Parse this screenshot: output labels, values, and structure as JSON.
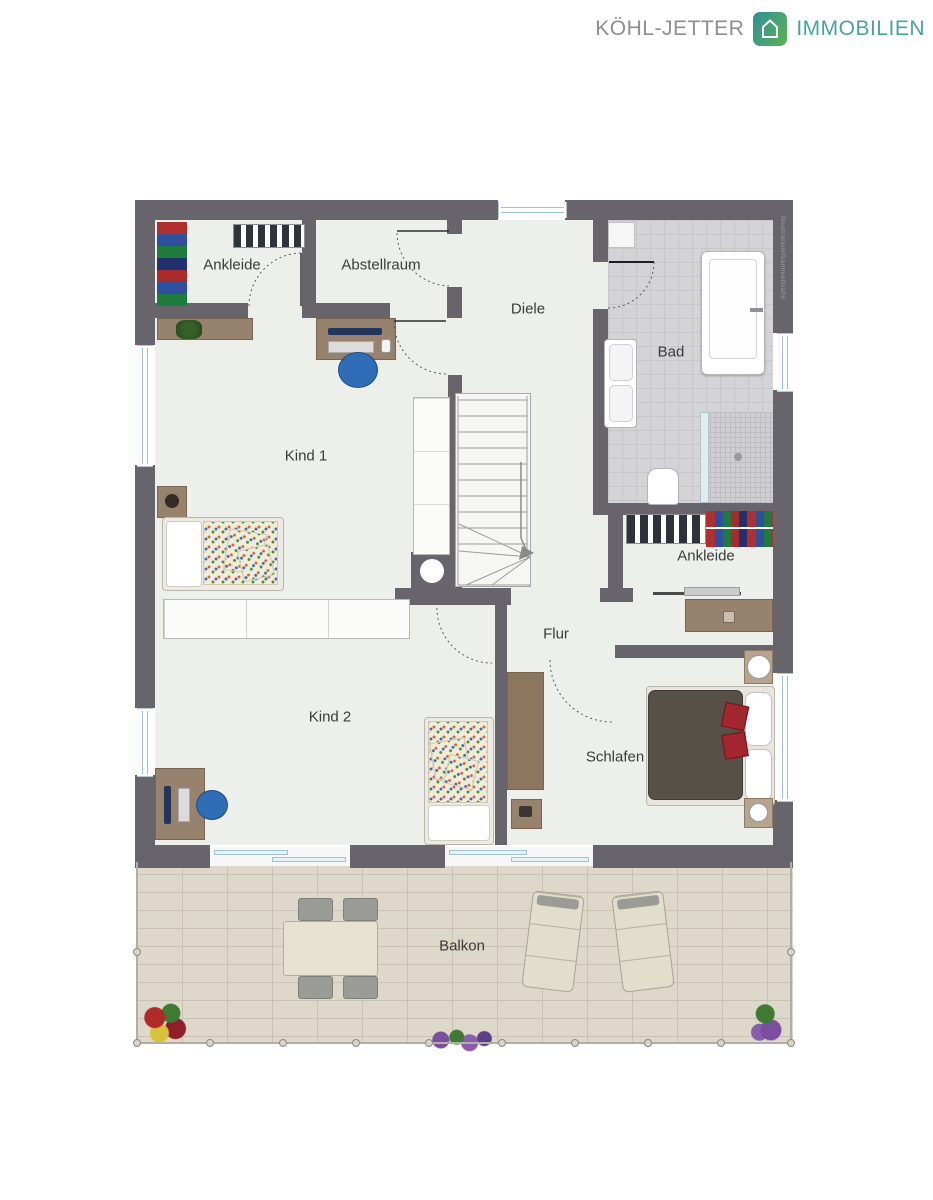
{
  "logo": {
    "brand": "KÖHL-JETTER",
    "suffix": "IMMOBILIEN",
    "icon": "house-icon",
    "colors": {
      "brand_gray": "#8f8f91",
      "accent_teal": "#4aa39b",
      "accent_green": "#5cb353"
    }
  },
  "watermark": "Illustration/GammaGrafik",
  "rooms": [
    {
      "label": "Ankleide"
    },
    {
      "label": "Abstellraum"
    },
    {
      "label": "Diele"
    },
    {
      "label": "Bad"
    },
    {
      "label": "Kind 1"
    },
    {
      "label": "Ankleide"
    },
    {
      "label": "Flur"
    },
    {
      "label": "Kind 2"
    },
    {
      "label": "Schlafen"
    },
    {
      "label": "Balkon"
    }
  ],
  "colors": {
    "wall": "#67646b",
    "room_floor": "#edf0ea",
    "bath_tile": "#d4d4d7",
    "balcony_paving": "#ded8cb",
    "wood": "#97826d",
    "chair_blue": "#2f6db6",
    "bed_blanket_dark": "#575049",
    "cushion_red": "#a3262e"
  }
}
